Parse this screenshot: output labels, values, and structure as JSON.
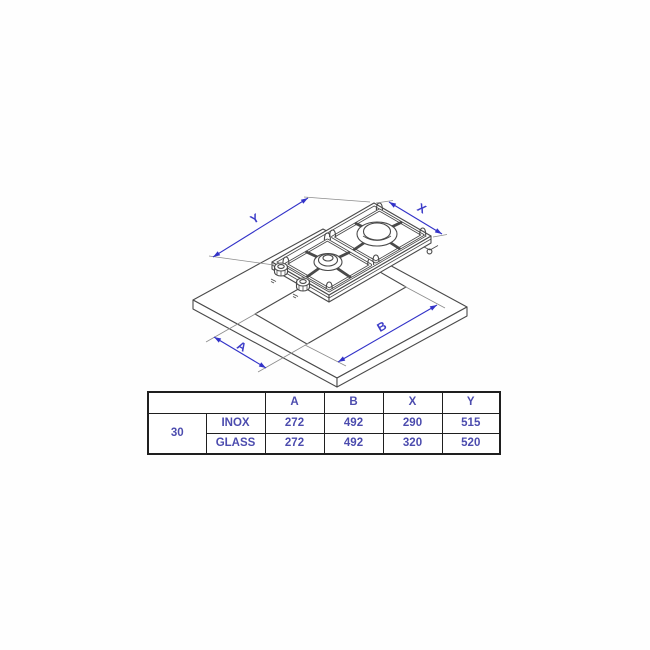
{
  "diagram": {
    "labels": {
      "y": "Y",
      "x": "X",
      "a": "A",
      "b": "B"
    }
  },
  "table": {
    "headers": [
      "A",
      "B",
      "X",
      "Y"
    ],
    "size": "30",
    "rows": [
      {
        "material": "INOX",
        "A": "272",
        "B": "492",
        "X": "290",
        "Y": "515"
      },
      {
        "material": "GLASS",
        "A": "272",
        "B": "492",
        "X": "320",
        "Y": "520"
      }
    ]
  },
  "colors": {
    "dimension_blue": "#3232c8",
    "drawing_gray": "#4a4a4a",
    "table_text_blue": "#4c4cae",
    "table_border": "#1f1f1f"
  }
}
